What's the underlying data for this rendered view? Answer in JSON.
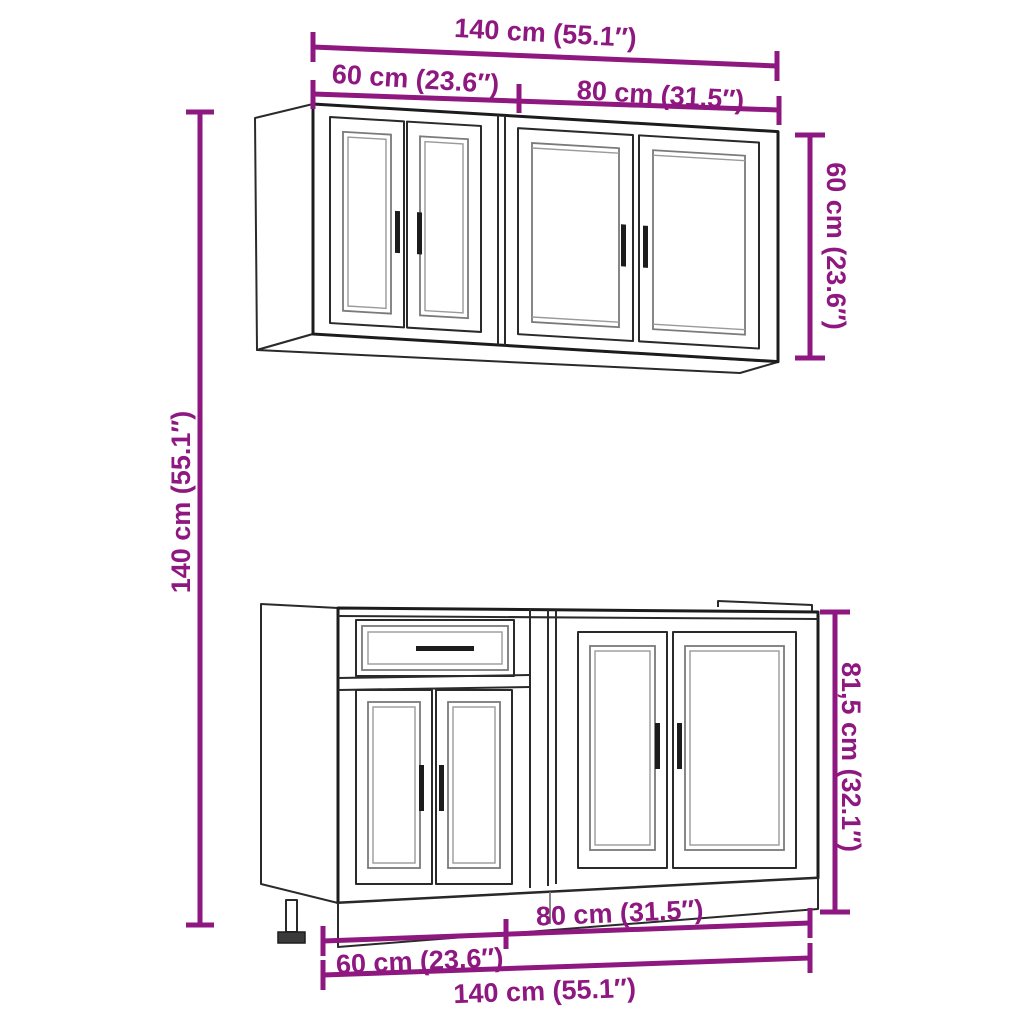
{
  "theme": {
    "background": "#ffffff",
    "dimension_color": "#8E1780",
    "outline_color": "#1c1c1c",
    "panel_frame_color": "#8a8a8a"
  },
  "diagram": {
    "subject": "kitchen-cabinet-set-dimension-diagram",
    "units_shown": [
      "cm",
      "inches"
    ],
    "wall_unit": {
      "width_total": "140 cm (55.1″)",
      "width_left": "60 cm (23.6″)",
      "width_right": "80 cm (31.5″)",
      "height": "60 cm (23.6″)"
    },
    "base_unit": {
      "width_total": "140 cm (55.1″)",
      "width_left": "60 cm (23.6″)",
      "width_right": "80 cm (31.5″)",
      "height": "81,5 cm (32.1″)"
    },
    "overall_height": "140 cm (55.1″)"
  }
}
